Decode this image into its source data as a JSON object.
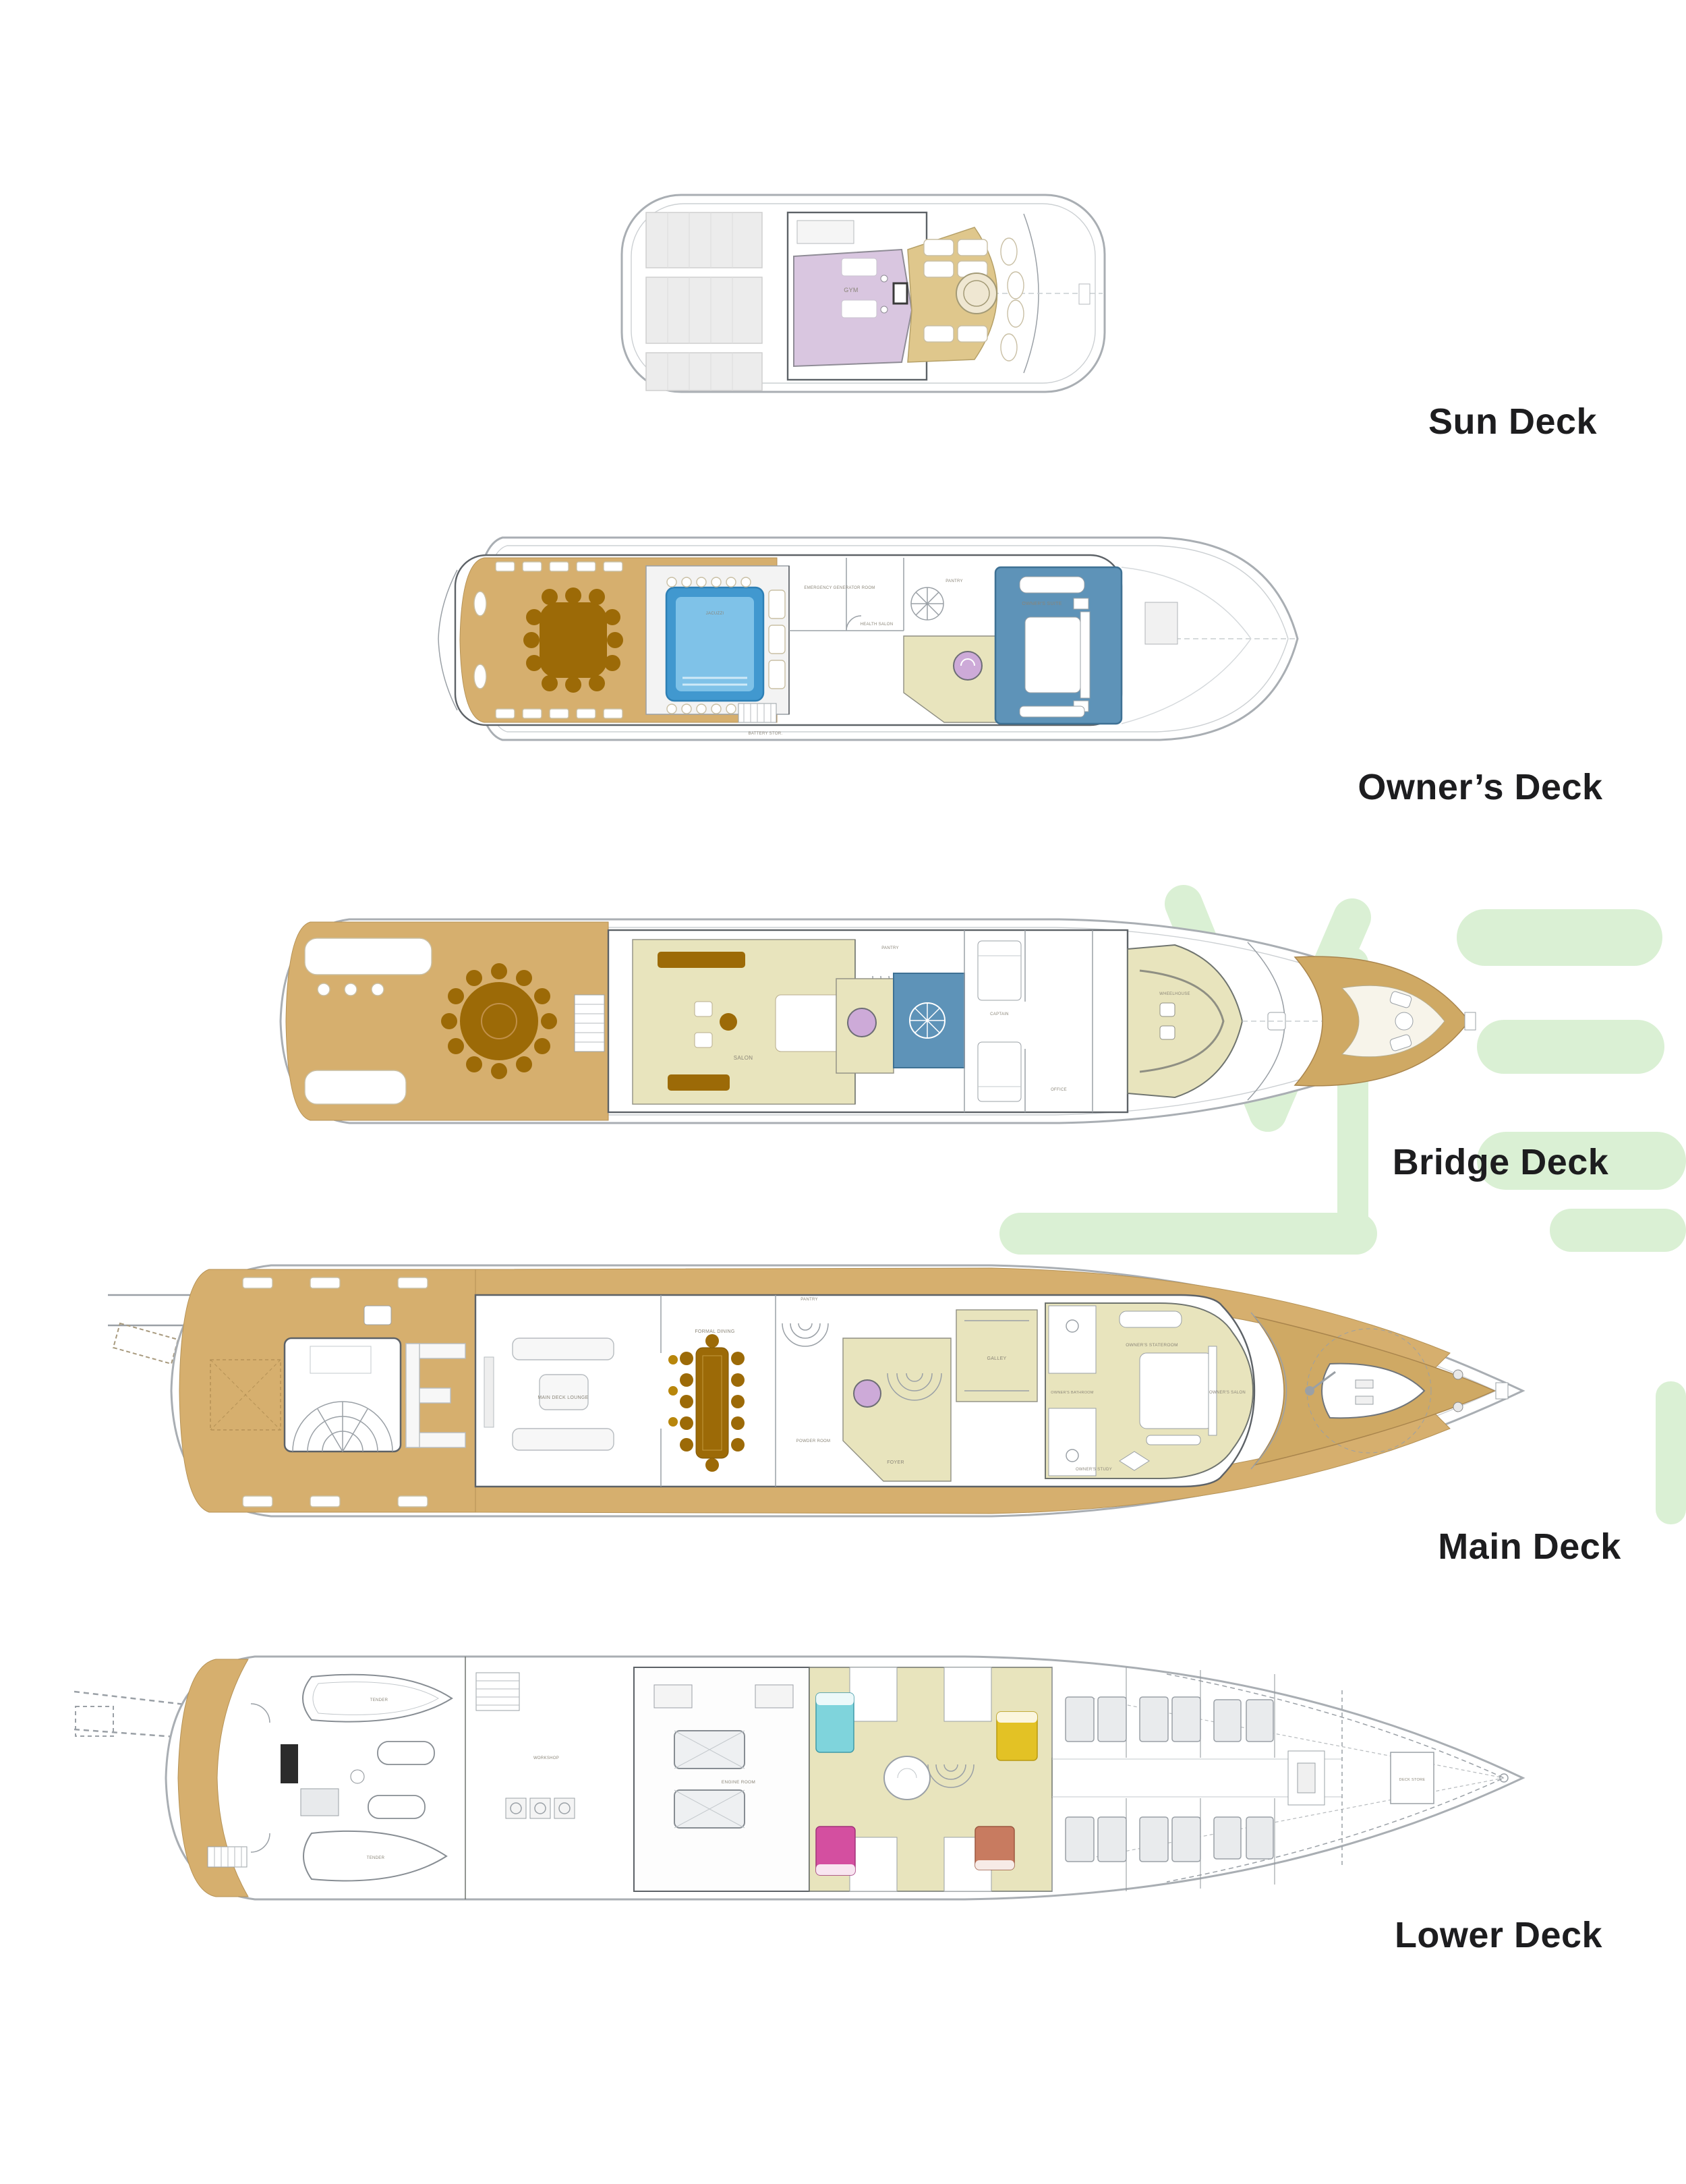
{
  "page_title": "Yacht Deck Plans",
  "deck_labels": {
    "sun": "Sun Deck",
    "owner": "Owner’s Deck",
    "bridge": "Bridge Deck",
    "main": "Main Deck",
    "lower": "Lower Deck"
  },
  "rooms": {
    "sun": {
      "gym": "GYM"
    },
    "owner": {
      "emergency": "EMERGENCY GENERATOR ROOM",
      "health": "HEALTH SALON",
      "pantry": "PANTRY",
      "jacuzzi": "JACUZZI",
      "suite": "OWNER'S SUITE",
      "battery": "BATTERY STOR."
    },
    "bridge": {
      "salon": "SALON",
      "pantry": "PANTRY",
      "captain": "CAPTAIN",
      "office": "OFFICE",
      "wheelhouse": "WHEELHOUSE"
    },
    "main": {
      "lounge": "MAIN DECK LOUNGE",
      "dining": "FORMAL DINING",
      "pantry": "PANTRY",
      "powder": "POWDER ROOM",
      "foyer": "FOYER",
      "galley": "GALLEY",
      "bathroom": "OWNER'S BATHROOM",
      "stateroom": "OWNER'S STATEROOM",
      "study": "OWNER'S STUDY",
      "salon": "OWNER'S SALON"
    },
    "lower": {
      "tender1": "TENDER",
      "tender2": "TENDER",
      "workshop": "WORKSHOP",
      "engine": "ENGINE ROOM",
      "deckstore": "DECK STORE"
    }
  },
  "colors": {
    "teak": "#d6af6e",
    "bowteak": "#cfa964",
    "sunteak": "#dfc78c",
    "khaki": "#e8e4bd",
    "wood": "#9c6a07",
    "pool": "#4198cf",
    "poolinner": "#7fc2e8",
    "suite": "#5e93b8",
    "purple": "#d9c6e0",
    "elevator": "#cdaad8",
    "cyan": "#7fd4dc",
    "yellow": "#e3c225",
    "magenta": "#d44fa0",
    "salmon": "#c87b60",
    "wm": "#daf0d4",
    "labeltext": "#1d1d1f"
  }
}
